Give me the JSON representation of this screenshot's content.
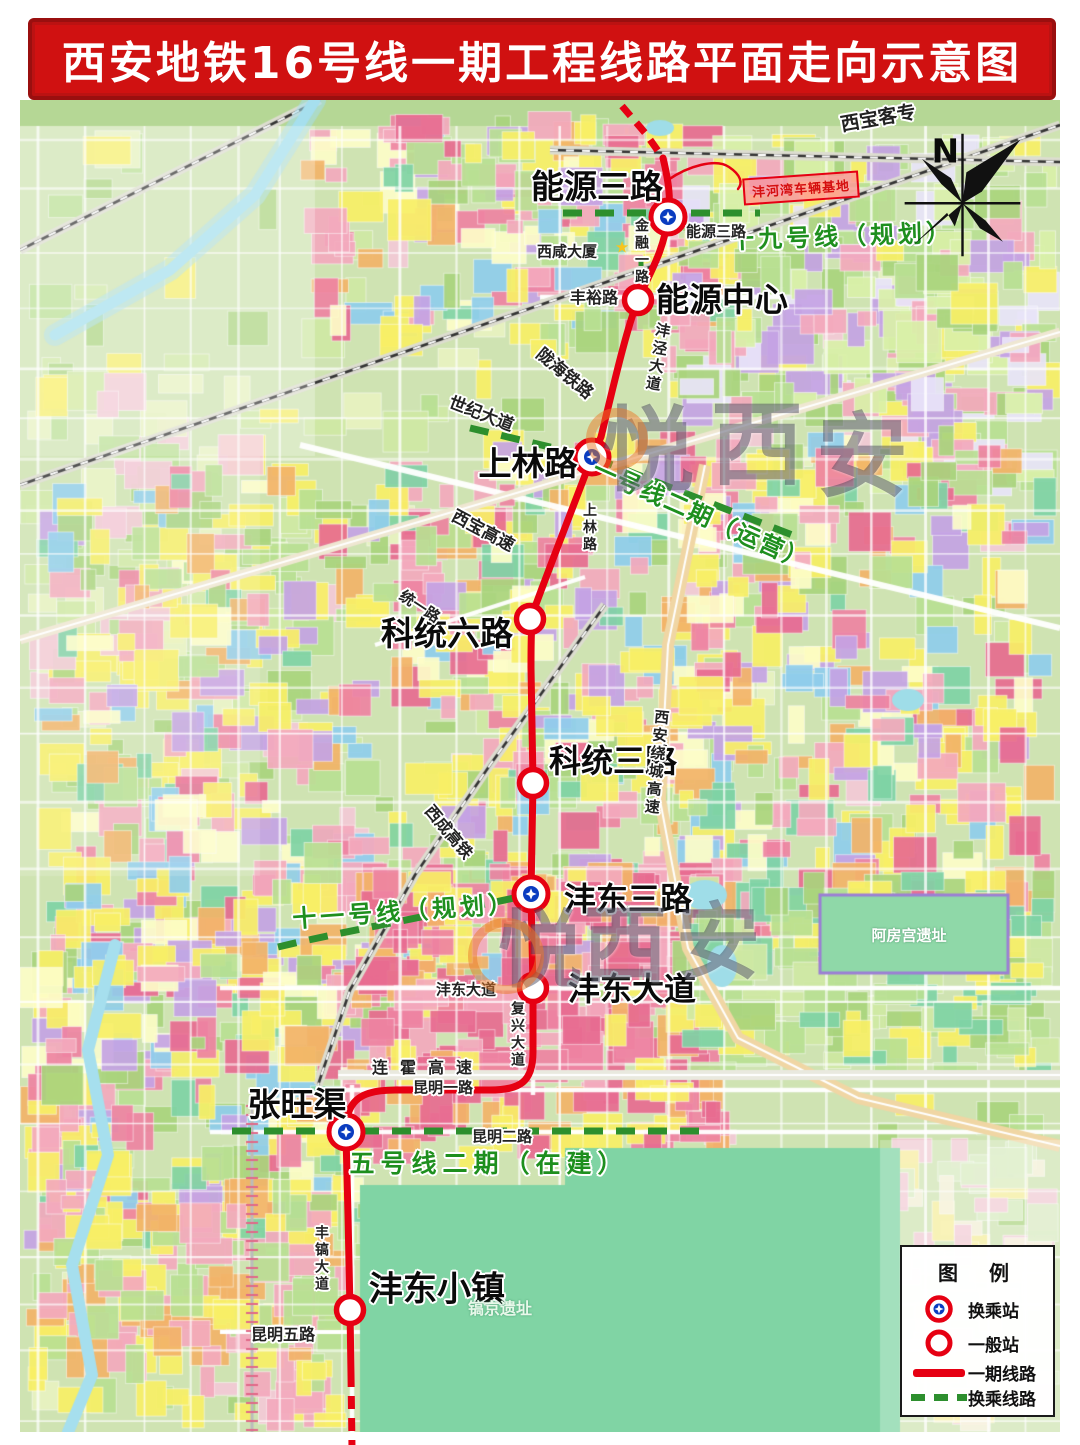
{
  "title": "西安地铁16号线一期工程线路平面走向示意图",
  "compass": {
    "label": "N"
  },
  "watermark": {
    "chars": [
      "悦",
      "西",
      "安"
    ]
  },
  "icons": {
    "tower_star": "★"
  },
  "line": {
    "stations": [
      {
        "name": "能源三路",
        "type": "transfer"
      },
      {
        "name": "能源中心",
        "type": "regular"
      },
      {
        "name": "上林路",
        "type": "transfer"
      },
      {
        "name": "科统六路",
        "type": "regular"
      },
      {
        "name": "科统三路",
        "type": "regular"
      },
      {
        "name": "沣东三路",
        "type": "transfer"
      },
      {
        "name": "沣东大道",
        "type": "regular"
      },
      {
        "name": "张旺渠",
        "type": "transfer"
      },
      {
        "name": "沣东小镇",
        "type": "regular"
      }
    ]
  },
  "transfer_lines": [
    {
      "label": "十九号线（规划）"
    },
    {
      "label": "一号线二期（运营）"
    },
    {
      "label": "十一号线（规划）"
    },
    {
      "label": "五号线二期（在建）"
    }
  ],
  "road_labels": [
    {
      "label": "西宝客专"
    },
    {
      "label": "金融一路"
    },
    {
      "label": "丰裕路"
    },
    {
      "label": "沣泾大道"
    },
    {
      "label": "陇海铁路"
    },
    {
      "label": "世纪大道"
    },
    {
      "label": "西宝高速"
    },
    {
      "label": "统一路"
    },
    {
      "label": "上林路"
    },
    {
      "label": "西安绕城高速"
    },
    {
      "label": "西成高铁"
    },
    {
      "label": "沣东大道"
    },
    {
      "label": "复兴大道"
    },
    {
      "label": "连霍高速"
    },
    {
      "label": "昆明一路"
    },
    {
      "label": "昆明二路"
    },
    {
      "label": "丰镐大道"
    },
    {
      "label": "昆明五路"
    }
  ],
  "place_labels": [
    {
      "label": "西咸大厦"
    },
    {
      "label": "沣河湾车辆基地"
    },
    {
      "label": "能源三路"
    },
    {
      "label": "阿房宫遗址"
    },
    {
      "label": "镐京遗址"
    }
  ],
  "legend": {
    "title": "图 例",
    "items": [
      {
        "label": "换乘站"
      },
      {
        "label": "一般站"
      },
      {
        "label": "一期线路"
      },
      {
        "label": "换乘线路"
      }
    ]
  },
  "colors": {
    "banner_red": "#d01111",
    "line_red": "#e60012",
    "transfer_green": "#2d8f2d",
    "label_green": "#1e8f1e",
    "transfer_core_blue": "#0a3cc0"
  }
}
